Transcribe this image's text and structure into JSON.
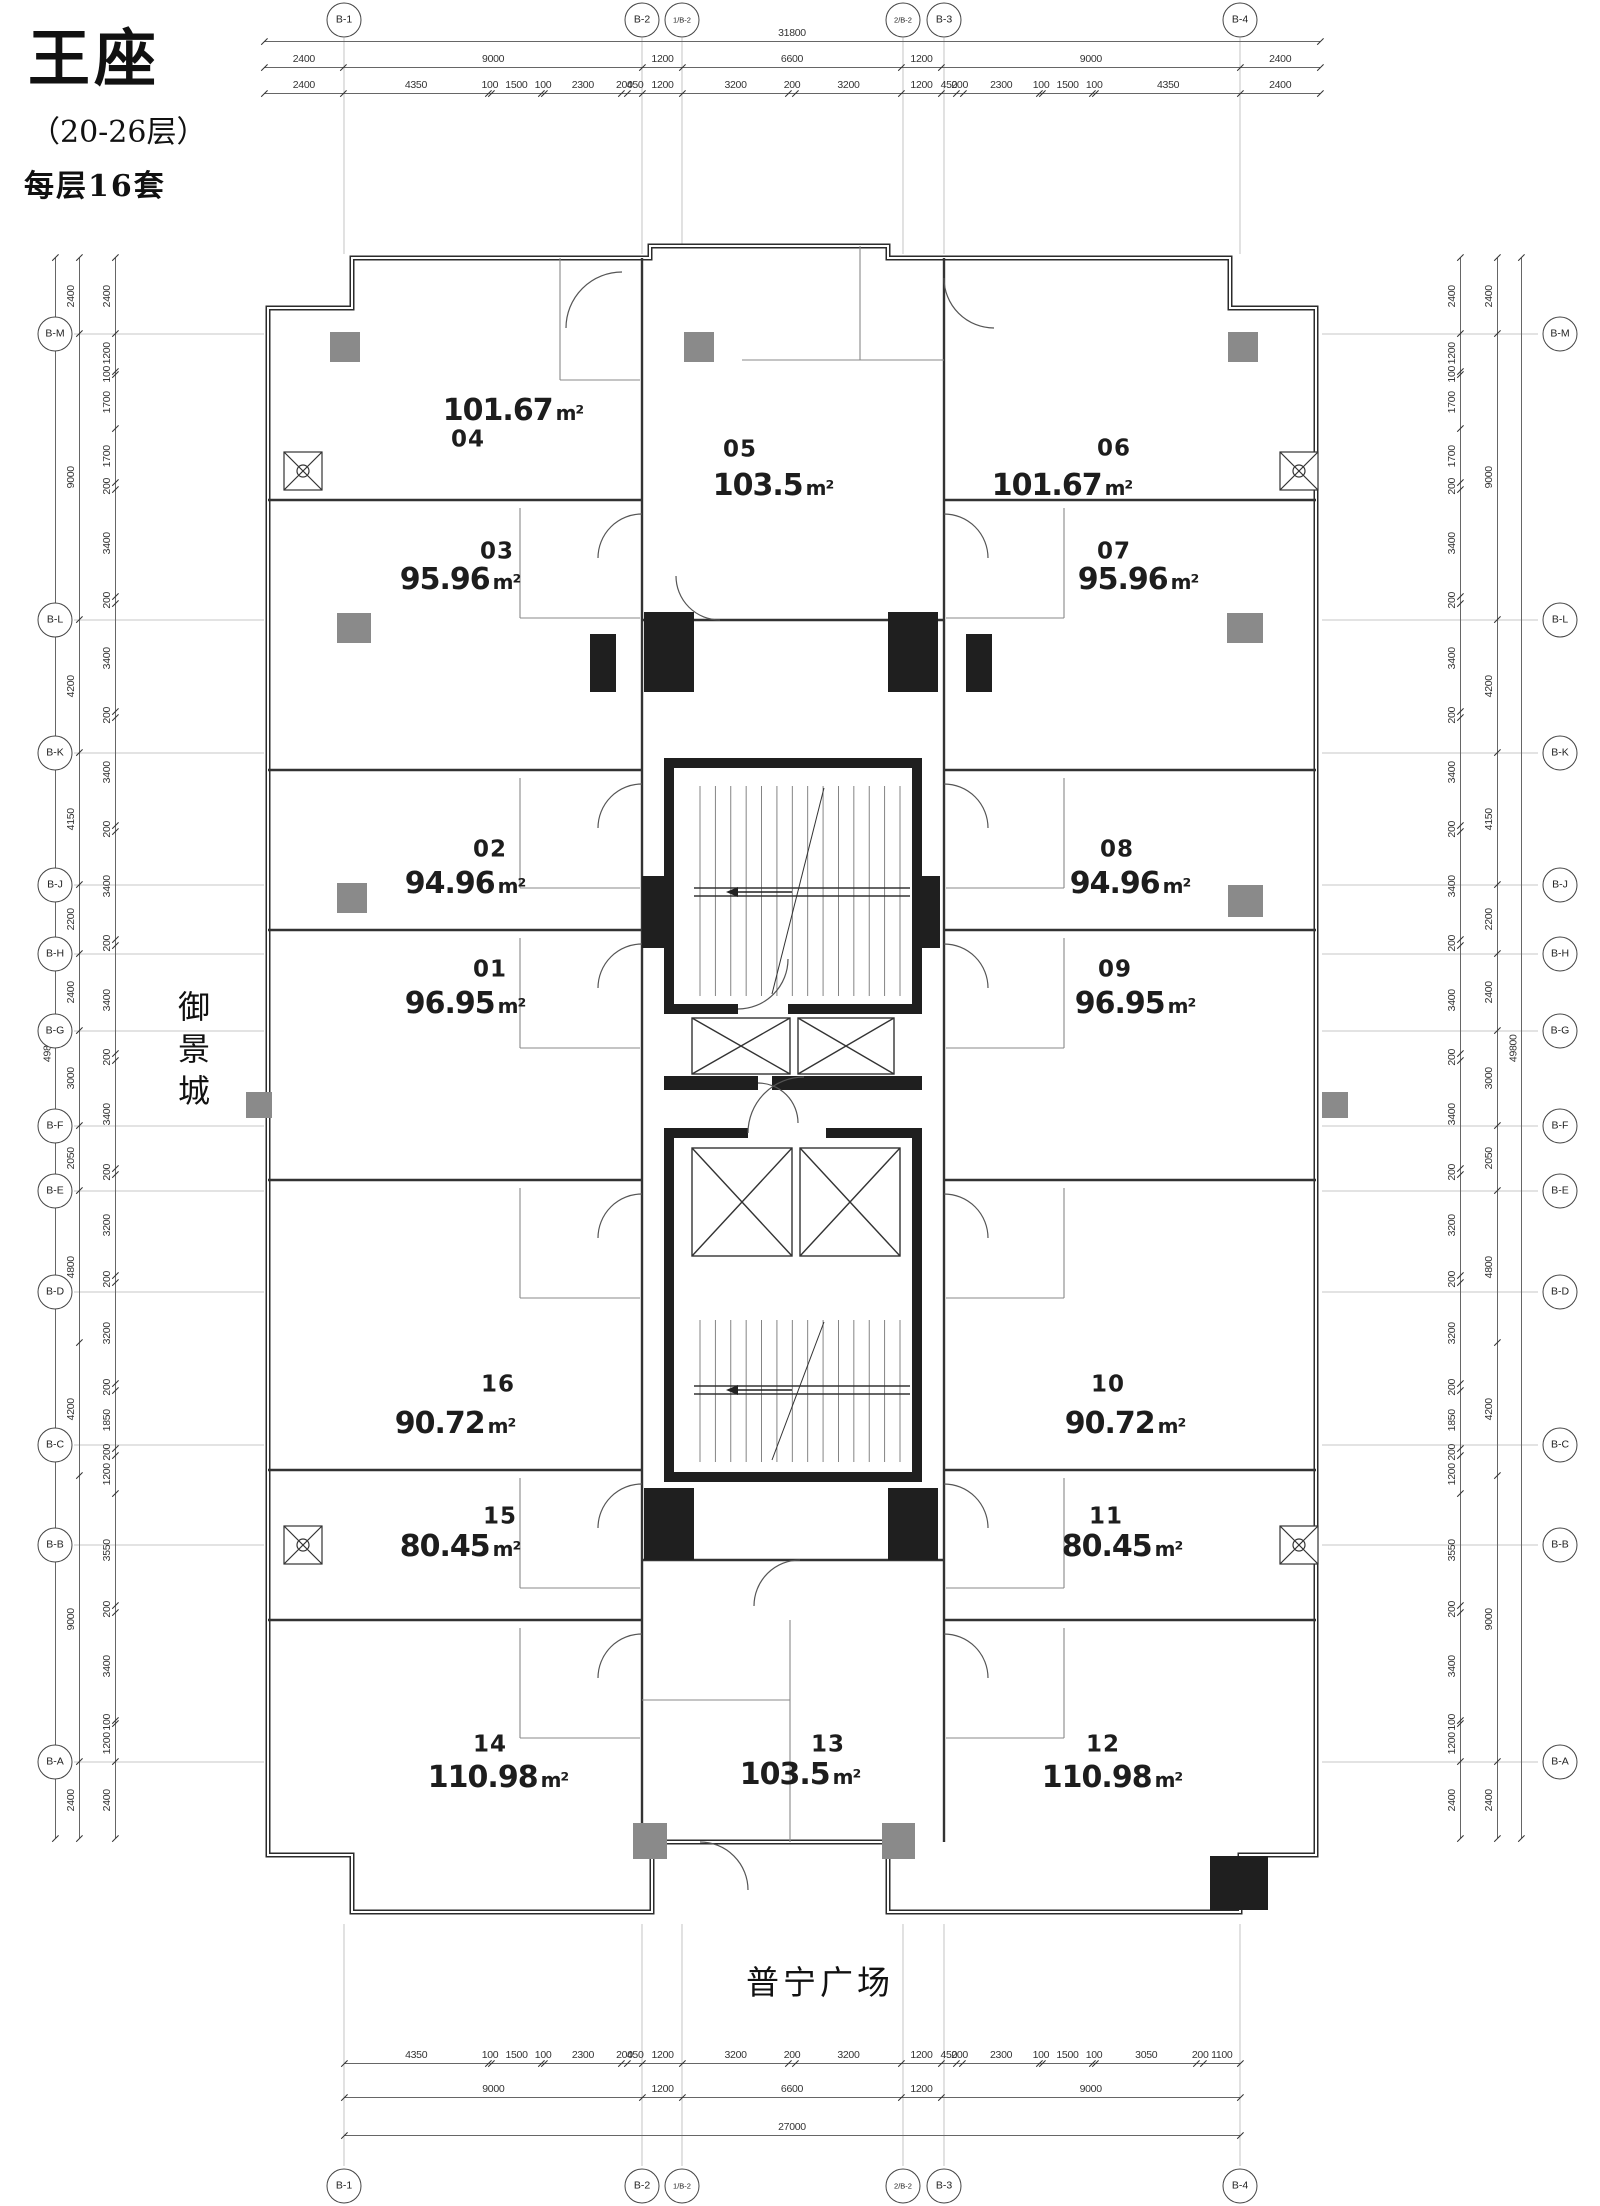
{
  "title": {
    "name": "王座",
    "floor_range": "（20-26层）",
    "units_per_floor": "每层16套"
  },
  "context_labels": {
    "left_side": "御景城",
    "bottom_side": "普宁广场"
  },
  "area_unit": "m²",
  "grid": {
    "top_bubbles": [
      "B-1",
      "B-2",
      "1/B-2",
      "2/B-2",
      "B-3",
      "B-4"
    ],
    "bottom_bubbles": [
      "B-1",
      "B-2",
      "1/B-2",
      "2/B-2",
      "B-3",
      "B-4"
    ],
    "left_bubbles": [
      "B-M",
      "B-L",
      "B-K",
      "B-J",
      "B-H",
      "B-G",
      "B-F",
      "B-E",
      "B-D",
      "B-C",
      "B-B",
      "B-A"
    ],
    "right_bubbles": [
      "B-M",
      "B-L",
      "B-K",
      "B-J",
      "B-H",
      "B-G",
      "B-F",
      "B-E",
      "B-D",
      "B-C",
      "B-B",
      "B-A"
    ]
  },
  "dimensions": {
    "top_total": [
      "31800"
    ],
    "top_major": [
      "2400",
      "9000",
      "1200",
      "6600",
      "1200",
      "9000",
      "2400"
    ],
    "top_minor": [
      "2400",
      "4350",
      "100",
      "1500",
      "100",
      "2300",
      "200",
      "450",
      "1200",
      "3200",
      "200",
      "3200",
      "1200",
      "450",
      "200",
      "2300",
      "100",
      "1500",
      "100",
      "4350",
      "2400"
    ],
    "bottom_minor": [
      "4350",
      "100",
      "1500",
      "100",
      "2300",
      "200",
      "450",
      "1200",
      "3200",
      "200",
      "3200",
      "1200",
      "450",
      "200",
      "2300",
      "100",
      "1500",
      "100",
      "3050",
      "200",
      "1100"
    ],
    "bottom_major": [
      "9000",
      "1200",
      "6600",
      "1200",
      "9000"
    ],
    "bottom_total": [
      "27000"
    ],
    "left_total": [
      "49800"
    ],
    "left_major": [
      "2400",
      "9000",
      "4200",
      "4150",
      "2200",
      "2400",
      "3000",
      "2050",
      "4800",
      "4200",
      "9000",
      "2400"
    ],
    "left_minor": [
      "2400",
      "1200",
      "100",
      "1700",
      "1700",
      "200",
      "3400",
      "200",
      "3400",
      "200",
      "3400",
      "200",
      "3400",
      "200",
      "3400",
      "200",
      "3400",
      "200",
      "3200",
      "200",
      "3200",
      "200",
      "1850",
      "200",
      "1200",
      "3550",
      "200",
      "3400",
      "100",
      "1200",
      "2400"
    ],
    "right_minor": [
      "2400",
      "1200",
      "100",
      "1700",
      "1700",
      "200",
      "3400",
      "200",
      "3400",
      "200",
      "3400",
      "200",
      "3400",
      "200",
      "3400",
      "200",
      "3400",
      "200",
      "3200",
      "200",
      "3200",
      "200",
      "1850",
      "200",
      "1200",
      "3550",
      "200",
      "3400",
      "100",
      "1200",
      "2400"
    ],
    "right_major": [
      "2400",
      "9000",
      "4200",
      "4150",
      "2200",
      "2400",
      "3000",
      "2050",
      "4800",
      "4200",
      "9000",
      "2400"
    ],
    "right_total": [
      "49800"
    ]
  },
  "units": [
    {
      "no": "01",
      "area": "96.95"
    },
    {
      "no": "02",
      "area": "94.96"
    },
    {
      "no": "03",
      "area": "95.96"
    },
    {
      "no": "04",
      "area": "101.67"
    },
    {
      "no": "05",
      "area": "103.5"
    },
    {
      "no": "06",
      "area": "101.67"
    },
    {
      "no": "07",
      "area": "95.96"
    },
    {
      "no": "08",
      "area": "94.96"
    },
    {
      "no": "09",
      "area": "96.95"
    },
    {
      "no": "10",
      "area": "90.72"
    },
    {
      "no": "11",
      "area": "80.45"
    },
    {
      "no": "12",
      "area": "110.98"
    },
    {
      "no": "13",
      "area": "103.5"
    },
    {
      "no": "14",
      "area": "110.98"
    },
    {
      "no": "15",
      "area": "80.45"
    },
    {
      "no": "16",
      "area": "90.72"
    }
  ]
}
